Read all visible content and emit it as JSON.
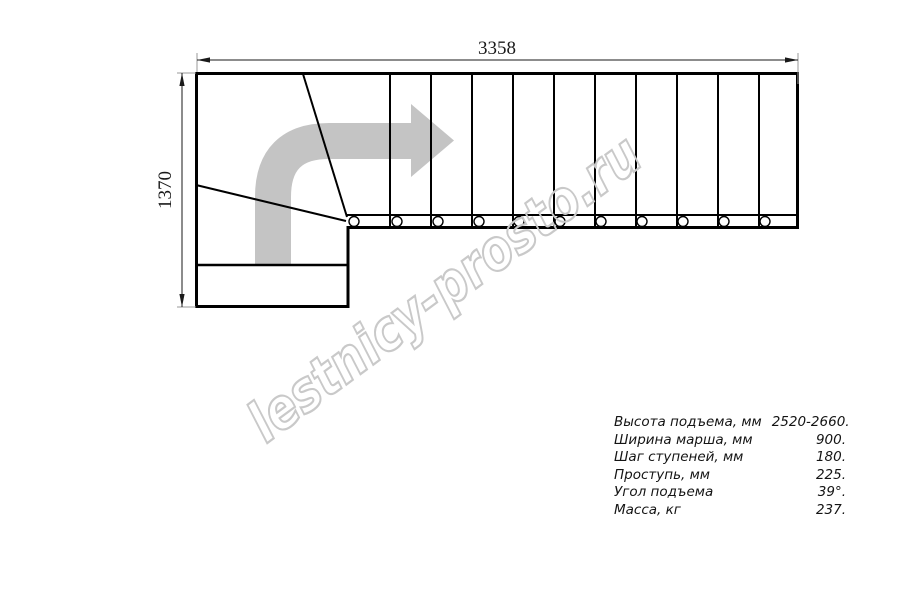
{
  "drawing": {
    "title": "stair-plan-top-view",
    "dimensions": {
      "width_label": "3358",
      "height_label": "1370"
    },
    "watermark": "lestnicy-prosto.ru",
    "colors": {
      "line": "#000000",
      "direction_arrow": "#c4c4c4",
      "watermark": "#c9c9c9",
      "extension_line": "#9a9a9a"
    }
  },
  "specs": {
    "rows": [
      {
        "label": "Высота подъема, мм",
        "value": "2520-2660."
      },
      {
        "label": "Ширина марша, мм",
        "value": "900."
      },
      {
        "label": "Шаг ступеней, мм",
        "value": "180."
      },
      {
        "label": "Проступь, мм",
        "value": "225."
      },
      {
        "label": "Угол подъема",
        "value": "39°."
      },
      {
        "label": "Масса, кг",
        "value": "237."
      }
    ]
  }
}
